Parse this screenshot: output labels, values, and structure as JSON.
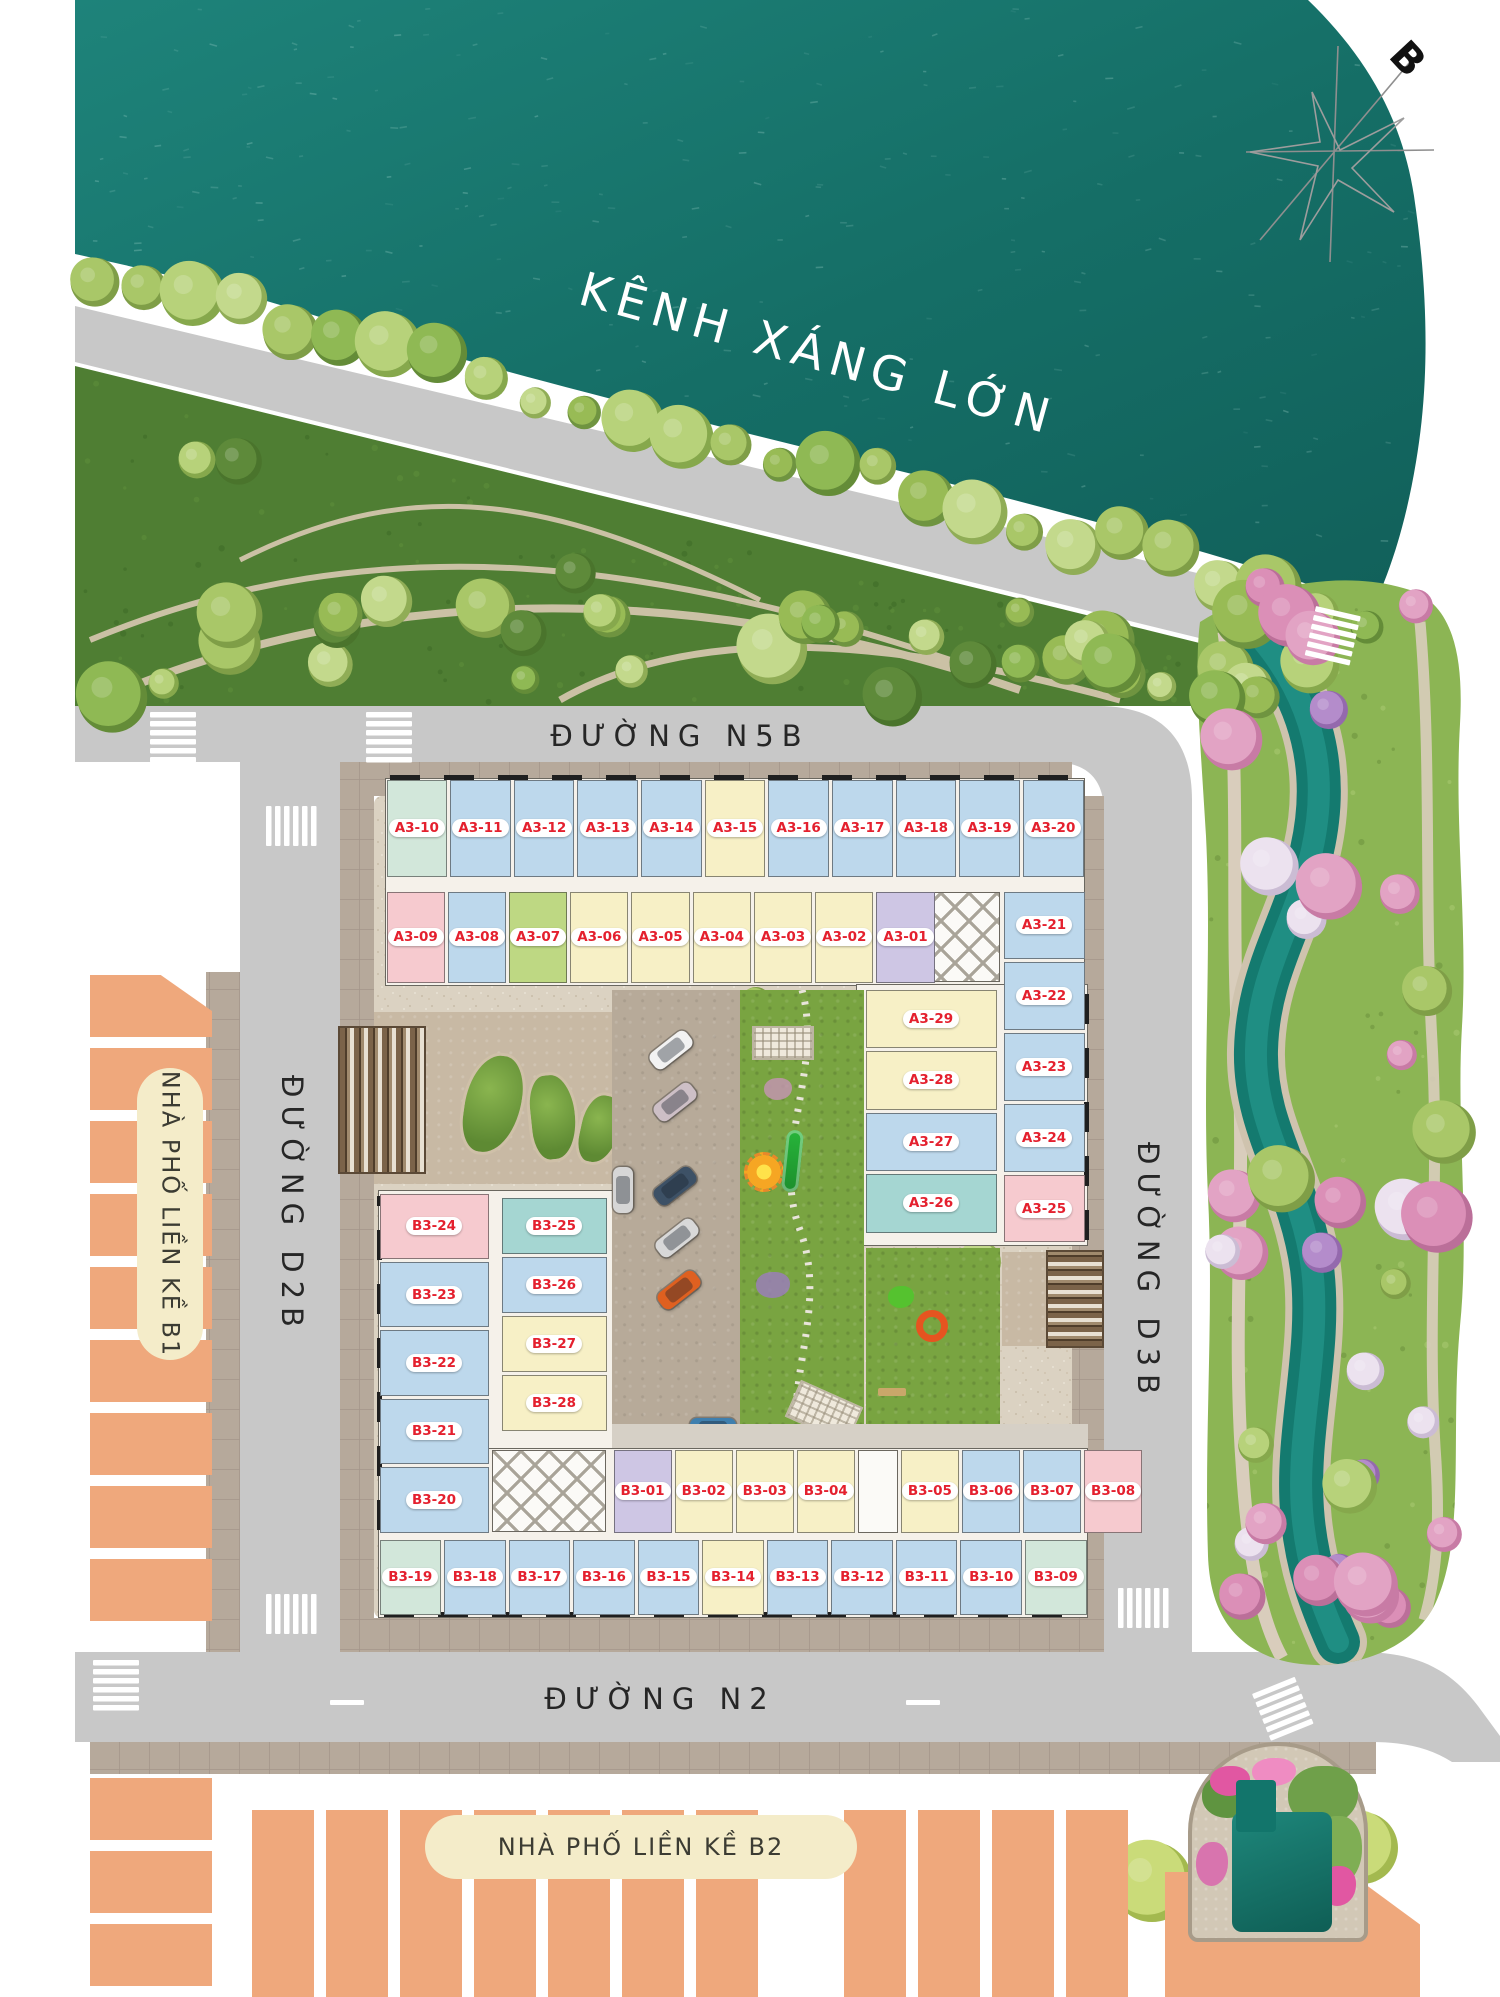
{
  "compass": {
    "label": "B"
  },
  "canal": {
    "name": "KÊNH XÁNG LỚN",
    "water_color": "#17726b"
  },
  "roads": {
    "n5b": {
      "name": "ĐƯỜNG N5B"
    },
    "d2b": {
      "name": "ĐƯỜNG D2B"
    },
    "d3b": {
      "name": "ĐƯỜNG D3B"
    },
    "n2": {
      "name": "ĐƯỜNG N2"
    },
    "surface_color": "#c8c8c8",
    "text_color": "#262626"
  },
  "townhouse_areas": {
    "b1": {
      "label": "NHÀ PHỐ LIỀN KỀ B1"
    },
    "b2": {
      "label": "NHÀ PHỐ LIỀN KỀ B2"
    },
    "lot_color": "#efa87c",
    "pill_color": "#f4ecc9"
  },
  "apartment_block": {
    "unit_label_color": "#e4202e",
    "unit_type_colors": {
      "blue": "#bdd8ec",
      "yellow": "#f7f0c6",
      "pink": "#f6cacf",
      "green": "#bed883",
      "purple": "#cec6e4",
      "teal": "#a5d6d2",
      "mint": "#d2e7da"
    },
    "wings": {
      "north_outer_row": [
        {
          "label": "A3-10",
          "color": "#d2e7da"
        },
        {
          "label": "A3-11",
          "color": "#bdd8ec"
        },
        {
          "label": "A3-12",
          "color": "#bdd8ec"
        },
        {
          "label": "A3-13",
          "color": "#bdd8ec"
        },
        {
          "label": "A3-14",
          "color": "#bdd8ec"
        },
        {
          "label": "A3-15",
          "color": "#f7f0c6"
        },
        {
          "label": "A3-16",
          "color": "#bdd8ec"
        },
        {
          "label": "A3-17",
          "color": "#bdd8ec"
        },
        {
          "label": "A3-18",
          "color": "#bdd8ec"
        },
        {
          "label": "A3-19",
          "color": "#bdd8ec"
        },
        {
          "label": "A3-20",
          "color": "#bdd8ec"
        }
      ],
      "north_inner_row": [
        {
          "label": "A3-09",
          "color": "#f6cacf"
        },
        {
          "label": "A3-08",
          "color": "#bdd8ec"
        },
        {
          "label": "A3-07",
          "color": "#bed883"
        },
        {
          "label": "A3-06",
          "color": "#f7f0c6"
        },
        {
          "label": "A3-05",
          "color": "#f7f0c6"
        },
        {
          "label": "A3-04",
          "color": "#f7f0c6"
        },
        {
          "label": "A3-03",
          "color": "#f7f0c6"
        },
        {
          "label": "A3-02",
          "color": "#f7f0c6"
        },
        {
          "label": "A3-01",
          "color": "#cec6e4"
        }
      ],
      "east_outer_column": [
        {
          "label": "A3-21",
          "color": "#bdd8ec"
        },
        {
          "label": "A3-22",
          "color": "#bdd8ec"
        },
        {
          "label": "A3-23",
          "color": "#bdd8ec"
        },
        {
          "label": "A3-24",
          "color": "#bdd8ec"
        },
        {
          "label": "A3-25",
          "color": "#f6cacf"
        }
      ],
      "east_inner_column": [
        {
          "label": "A3-29",
          "color": "#f7f0c6"
        },
        {
          "label": "A3-28",
          "color": "#f7f0c6"
        },
        {
          "label": "A3-27",
          "color": "#bdd8ec"
        },
        {
          "label": "A3-26",
          "color": "#a5d6d2"
        }
      ],
      "west_outer_column": [
        {
          "label": "B3-24",
          "color": "#f6cacf"
        },
        {
          "label": "B3-23",
          "color": "#bdd8ec"
        },
        {
          "label": "B3-22",
          "color": "#bdd8ec"
        },
        {
          "label": "B3-21",
          "color": "#bdd8ec"
        },
        {
          "label": "B3-20",
          "color": "#bdd8ec"
        }
      ],
      "west_inner_column": [
        {
          "label": "B3-25",
          "color": "#a5d6d2"
        },
        {
          "label": "B3-26",
          "color": "#bdd8ec"
        },
        {
          "label": "B3-27",
          "color": "#f7f0c6"
        },
        {
          "label": "B3-28",
          "color": "#f7f0c6"
        }
      ],
      "south_inner_row": [
        {
          "label": "B3-01",
          "color": "#cec6e4"
        },
        {
          "label": "B3-02",
          "color": "#f7f0c6"
        },
        {
          "label": "B3-03",
          "color": "#f7f0c6"
        },
        {
          "label": "B3-04",
          "color": "#f7f0c6"
        },
        {
          "label": "B3-05",
          "color": "#f7f0c6"
        },
        {
          "label": "B3-06",
          "color": "#bdd8ec"
        },
        {
          "label": "B3-07",
          "color": "#bdd8ec"
        },
        {
          "label": "B3-08",
          "color": "#f6cacf"
        }
      ],
      "south_outer_row": [
        {
          "label": "B3-19",
          "color": "#d2e7da"
        },
        {
          "label": "B3-18",
          "color": "#bdd8ec"
        },
        {
          "label": "B3-17",
          "color": "#bdd8ec"
        },
        {
          "label": "B3-16",
          "color": "#bdd8ec"
        },
        {
          "label": "B3-15",
          "color": "#bdd8ec"
        },
        {
          "label": "B3-14",
          "color": "#f7f0c6"
        },
        {
          "label": "B3-13",
          "color": "#bdd8ec"
        },
        {
          "label": "B3-12",
          "color": "#bdd8ec"
        },
        {
          "label": "B3-11",
          "color": "#bdd8ec"
        },
        {
          "label": "B3-10",
          "color": "#bdd8ec"
        },
        {
          "label": "B3-09",
          "color": "#d2e7da"
        }
      ]
    }
  }
}
